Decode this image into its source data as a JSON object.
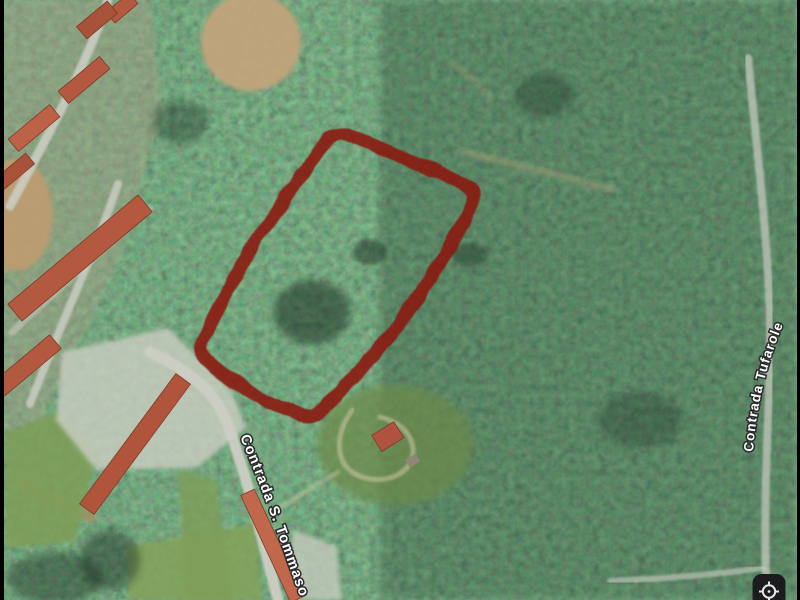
{
  "map": {
    "road_labels": [
      {
        "text": "Contrada S. Tommaso"
      },
      {
        "text": "Contrada Tufarole"
      }
    ]
  },
  "overlay": {
    "parcel_outline": {
      "color": "#8b170e",
      "stroke_width": "13",
      "opacity": "0.87",
      "path": "M 204 336 Q 256 230 330 138 Q 340 129 352 136 Q 412 160 462 184 Q 476 192 471 206 Q 414 320 323 409 Q 313 419 299 413 Q 250 398 210 363 Q 196 350 204 336 Z"
    }
  },
  "controls": {
    "location_button": {
      "icon": "my-location-icon"
    }
  },
  "frame": {
    "letterbox_color": "#000000"
  }
}
